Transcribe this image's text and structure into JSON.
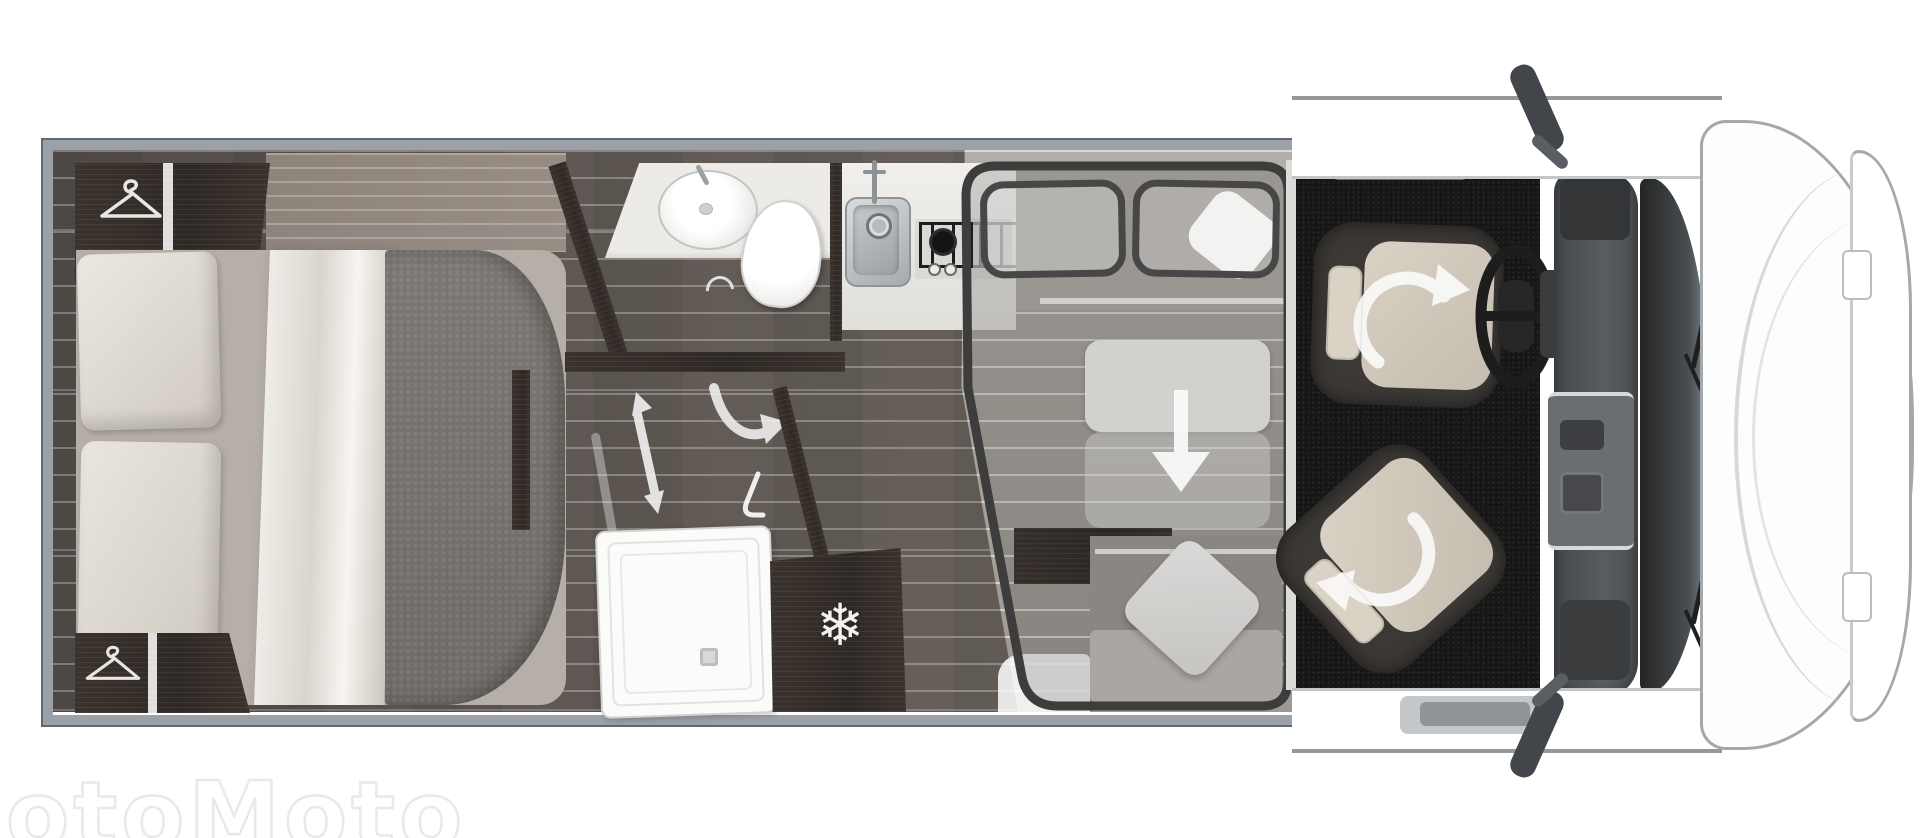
{
  "page": {
    "width": 1920,
    "height": 838,
    "background": "#ffffff"
  },
  "watermark": {
    "text": "otoMoto"
  },
  "floorplan": {
    "type": "motorhome-top-view",
    "snowflake_glyph": "❄",
    "zones": [
      "bedroom",
      "bathroom",
      "kitchen",
      "dinette-drop-down-bed",
      "cab"
    ],
    "icons": [
      {
        "name": "hanger-icon",
        "location": "wardrobe-top-left"
      },
      {
        "name": "hanger-icon",
        "location": "wardrobe-bottom-left"
      },
      {
        "name": "snowflake-icon",
        "glyph": "❄",
        "location": "fridge"
      },
      {
        "name": "sliding-door-arrow",
        "location": "bathroom"
      },
      {
        "name": "door-swing-arrow",
        "location": "bathroom"
      },
      {
        "name": "door-hook-icon",
        "location": "bathroom"
      },
      {
        "name": "drop-down-arrow",
        "location": "dinette-table"
      },
      {
        "name": "swivel-arrow",
        "location": "driver-seat"
      },
      {
        "name": "swivel-arrow",
        "location": "passenger-seat"
      }
    ]
  },
  "palette": {
    "frame-gray": "#9ba1a7",
    "wood-dark": "#352e2a",
    "counter": "#edebe7",
    "seat-beige": "#d9d2c5",
    "overlay-stroke": "#3d3d3d",
    "arrow-white": "#f2f2f0",
    "body-outline": "#a3a8ac",
    "mat-black": "#161616"
  }
}
